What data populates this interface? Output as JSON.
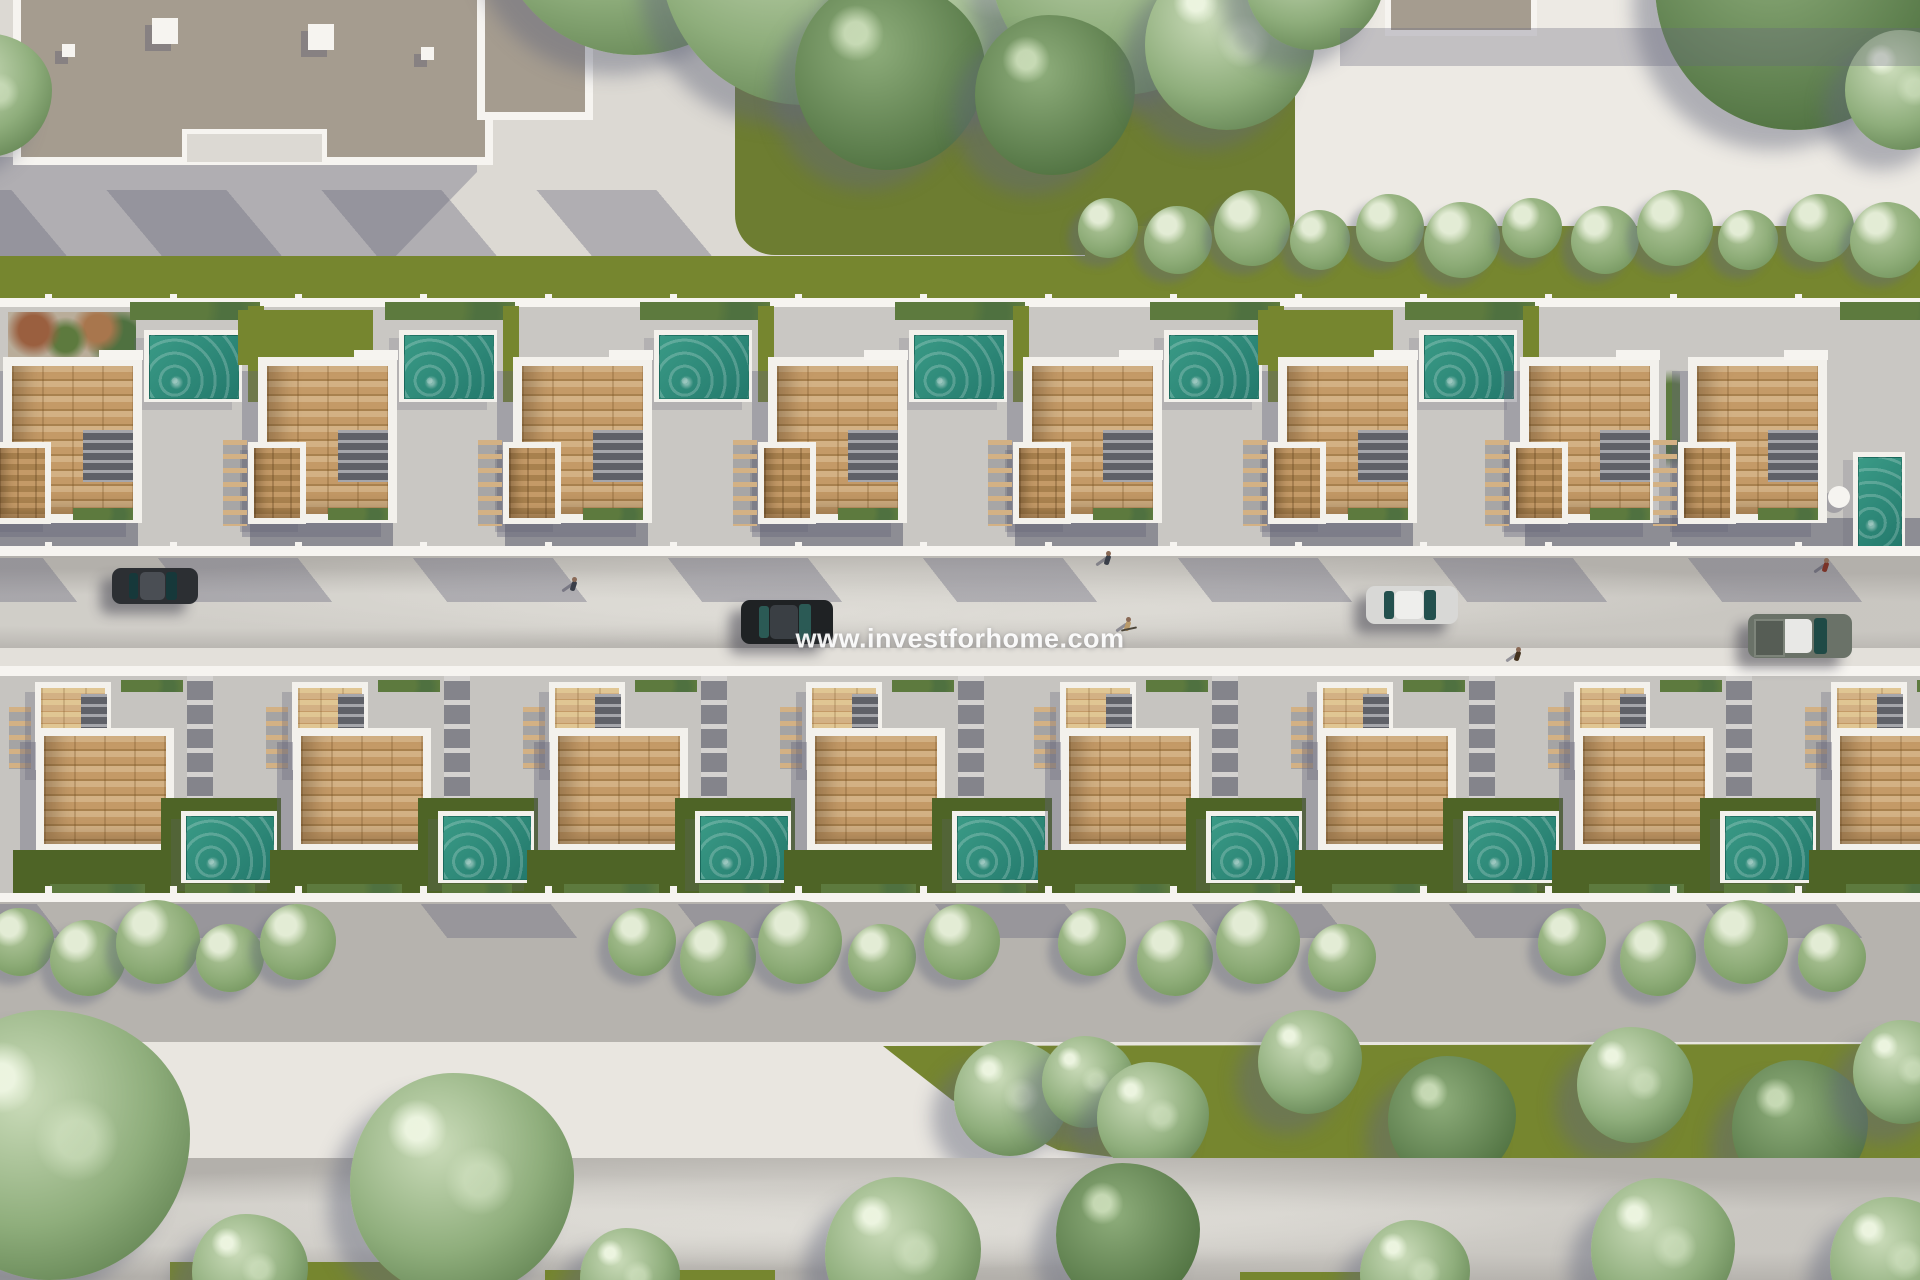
{
  "watermark": {
    "text": "www.investforhome.com"
  },
  "palette": {
    "pavement": "#dcd9d3",
    "pavementLight": "#e9e6e0",
    "plaza": "#edeae4",
    "patio1": "#c9c7c3",
    "patio2": "#c6c4c0",
    "road": "#b3b0ab",
    "roadLow": "#b6b3ae",
    "sidewalkWhite": "#e3e0da",
    "wallWhite": "#f6f4f0",
    "parapet": "#f3f1ec",
    "facade": "#8d8d94",
    "pathDark": "#84848b",
    "stair": "#5f6168",
    "wood": "#c49a67",
    "woodDark": "#a8814e",
    "woodLight": "#d3b184",
    "grass": "#76862f",
    "grassDark": "#4e6426",
    "grassOlive": "#6d7d31",
    "hedge": "#5d7a3e",
    "treeSage": "#8fae7c",
    "treeLight": "#cbdcba",
    "treeDark": "#4f7140",
    "pool": "#3a9a86",
    "poolDark": "#23796c",
    "buildingTaupe": "#a59c8f",
    "shadow": "rgba(104,104,124,0.38)"
  },
  "scene": {
    "rows": {
      "row1": {
        "y": 302,
        "units": [
          {
            "x": 3,
            "pool_x": 152,
            "pool": "h",
            "back": "planter"
          },
          {
            "x": 258,
            "pool_x": 407,
            "pool": "h",
            "back": "grass"
          },
          {
            "x": 513,
            "pool_x": 662,
            "pool": "h",
            "back": null
          },
          {
            "x": 768,
            "pool_x": 917,
            "pool": "h",
            "back": null
          },
          {
            "x": 1023,
            "pool_x": 1172,
            "pool": "h",
            "back": null
          },
          {
            "x": 1278,
            "pool_x": 1427,
            "pool": "h",
            "back": "grass"
          },
          {
            "x": 1520,
            "pool_x": null,
            "pool": null,
            "back": null
          },
          {
            "x": 1688,
            "pool_x": 1853,
            "pool": "v",
            "back": null
          }
        ]
      },
      "row2": {
        "y": 668,
        "units_x": [
          35,
          292,
          549,
          806,
          1060,
          1317,
          1574,
          1831
        ]
      }
    },
    "buildings": {
      "top_left": {
        "x": 13,
        "y": 0,
        "w": 464,
        "h": 157,
        "ext_x": 477,
        "ext_w": 100,
        "ext_h": 112,
        "notch": {
          "x": 182,
          "y": 129,
          "w": 135,
          "h": 28
        },
        "roof_cubes": [
          [
            152,
            18,
            26
          ],
          [
            308,
            24,
            26
          ],
          [
            62,
            44,
            13
          ],
          [
            421,
            47,
            13
          ]
        ]
      },
      "top_right": {
        "x": 1385,
        "y": 0,
        "w": 140,
        "h": 30
      }
    },
    "trees_top": [
      {
        "x": 640,
        "y": -95,
        "r": 150
      },
      {
        "x": 810,
        "y": -45,
        "r": 150
      },
      {
        "x": 975,
        "y": -15,
        "r": 125
      },
      {
        "x": 1125,
        "y": -40,
        "r": 135
      },
      {
        "x": 890,
        "y": 75,
        "r": 95,
        "dark": true
      },
      {
        "x": 1055,
        "y": 95,
        "r": 80,
        "dark": true
      },
      {
        "x": 1230,
        "y": 45,
        "r": 85
      },
      {
        "x": 1315,
        "y": -20,
        "r": 70
      },
      {
        "x": -10,
        "y": 95,
        "r": 62
      },
      {
        "x": 1800,
        "y": -15,
        "r": 145,
        "dark": true
      },
      {
        "x": 1905,
        "y": 90,
        "r": 60
      }
    ],
    "hedge_bushes_top": {
      "y": 232,
      "r": 30,
      "xs": [
        1108,
        1178,
        1252,
        1320,
        1390,
        1462,
        1532,
        1605,
        1675,
        1748,
        1820,
        1888
      ]
    },
    "sidewalk_bushes": {
      "y": 948,
      "clusters": [
        [
          20,
          88,
          158,
          230,
          298
        ],
        [
          642,
          718,
          800,
          882,
          962
        ],
        [
          1092,
          1175,
          1258,
          1342
        ],
        [
          1572,
          1658,
          1746,
          1832
        ]
      ]
    },
    "wedge": {
      "points": [
        [
          883,
          1046
        ],
        [
          1920,
          1044
        ],
        [
          1920,
          1164
        ],
        [
          1540,
          1172
        ],
        [
          1230,
          1172
        ],
        [
          1058,
          1150
        ],
        [
          952,
          1100
        ]
      ]
    },
    "wedge_trees": [
      {
        "x": 1012,
        "y": 1098,
        "r": 58
      },
      {
        "x": 1088,
        "y": 1082,
        "r": 46
      },
      {
        "x": 1153,
        "y": 1118,
        "r": 56
      },
      {
        "x": 1310,
        "y": 1062,
        "r": 52
      },
      {
        "x": 1452,
        "y": 1120,
        "r": 64,
        "dark": true
      },
      {
        "x": 1635,
        "y": 1085,
        "r": 58
      },
      {
        "x": 1800,
        "y": 1128,
        "r": 68,
        "dark": true
      },
      {
        "x": 1905,
        "y": 1072,
        "r": 52
      }
    ],
    "trees_bottom": [
      {
        "x": 55,
        "y": 1145,
        "r": 135
      },
      {
        "x": 462,
        "y": 1185,
        "r": 112
      },
      {
        "x": 250,
        "y": 1272,
        "r": 58
      },
      {
        "x": 630,
        "y": 1278,
        "r": 50
      },
      {
        "x": 903,
        "y": 1255,
        "r": 78
      },
      {
        "x": 1128,
        "y": 1235,
        "r": 72,
        "dark": true
      },
      {
        "x": 1415,
        "y": 1275,
        "r": 55
      },
      {
        "x": 1663,
        "y": 1250,
        "r": 72
      },
      {
        "x": 1895,
        "y": 1262,
        "r": 65
      }
    ],
    "cars": [
      {
        "label": "dark-suv",
        "x": 112,
        "y": 568,
        "w": 86,
        "h": 36,
        "body": "#2c2f33",
        "roof": "#4a4e54",
        "glass": "#16383a"
      },
      {
        "label": "black-sedan",
        "x": 741,
        "y": 600,
        "w": 92,
        "h": 44,
        "body": "#1f2224",
        "roof": "#3a3f44",
        "glass": "#2b5a55"
      },
      {
        "label": "silver-sedan",
        "x": 1366,
        "y": 586,
        "w": 92,
        "h": 38,
        "body": "#d8d8d6",
        "roof": "#eeeeec",
        "glass": "#23504e"
      },
      {
        "label": "gray-pickup",
        "x": 1748,
        "y": 614,
        "w": 104,
        "h": 44,
        "body": "#6a7268",
        "roof": "#e8e8e6",
        "glass": "#1f4a46",
        "bed": true
      }
    ],
    "people": [
      {
        "x": 574,
        "y": 584,
        "color": "#3a3f49",
        "label": "pedestrian"
      },
      {
        "x": 1108,
        "y": 558,
        "color": "#3a3f49",
        "label": "pedestrian"
      },
      {
        "x": 1128,
        "y": 624,
        "color": "#b99a6a",
        "label": "cyclist",
        "bike": true
      },
      {
        "x": 1518,
        "y": 654,
        "color": "#44331f",
        "label": "pedestrian"
      },
      {
        "x": 1826,
        "y": 565,
        "color": "#7a3328",
        "label": "pedestrian"
      }
    ]
  }
}
